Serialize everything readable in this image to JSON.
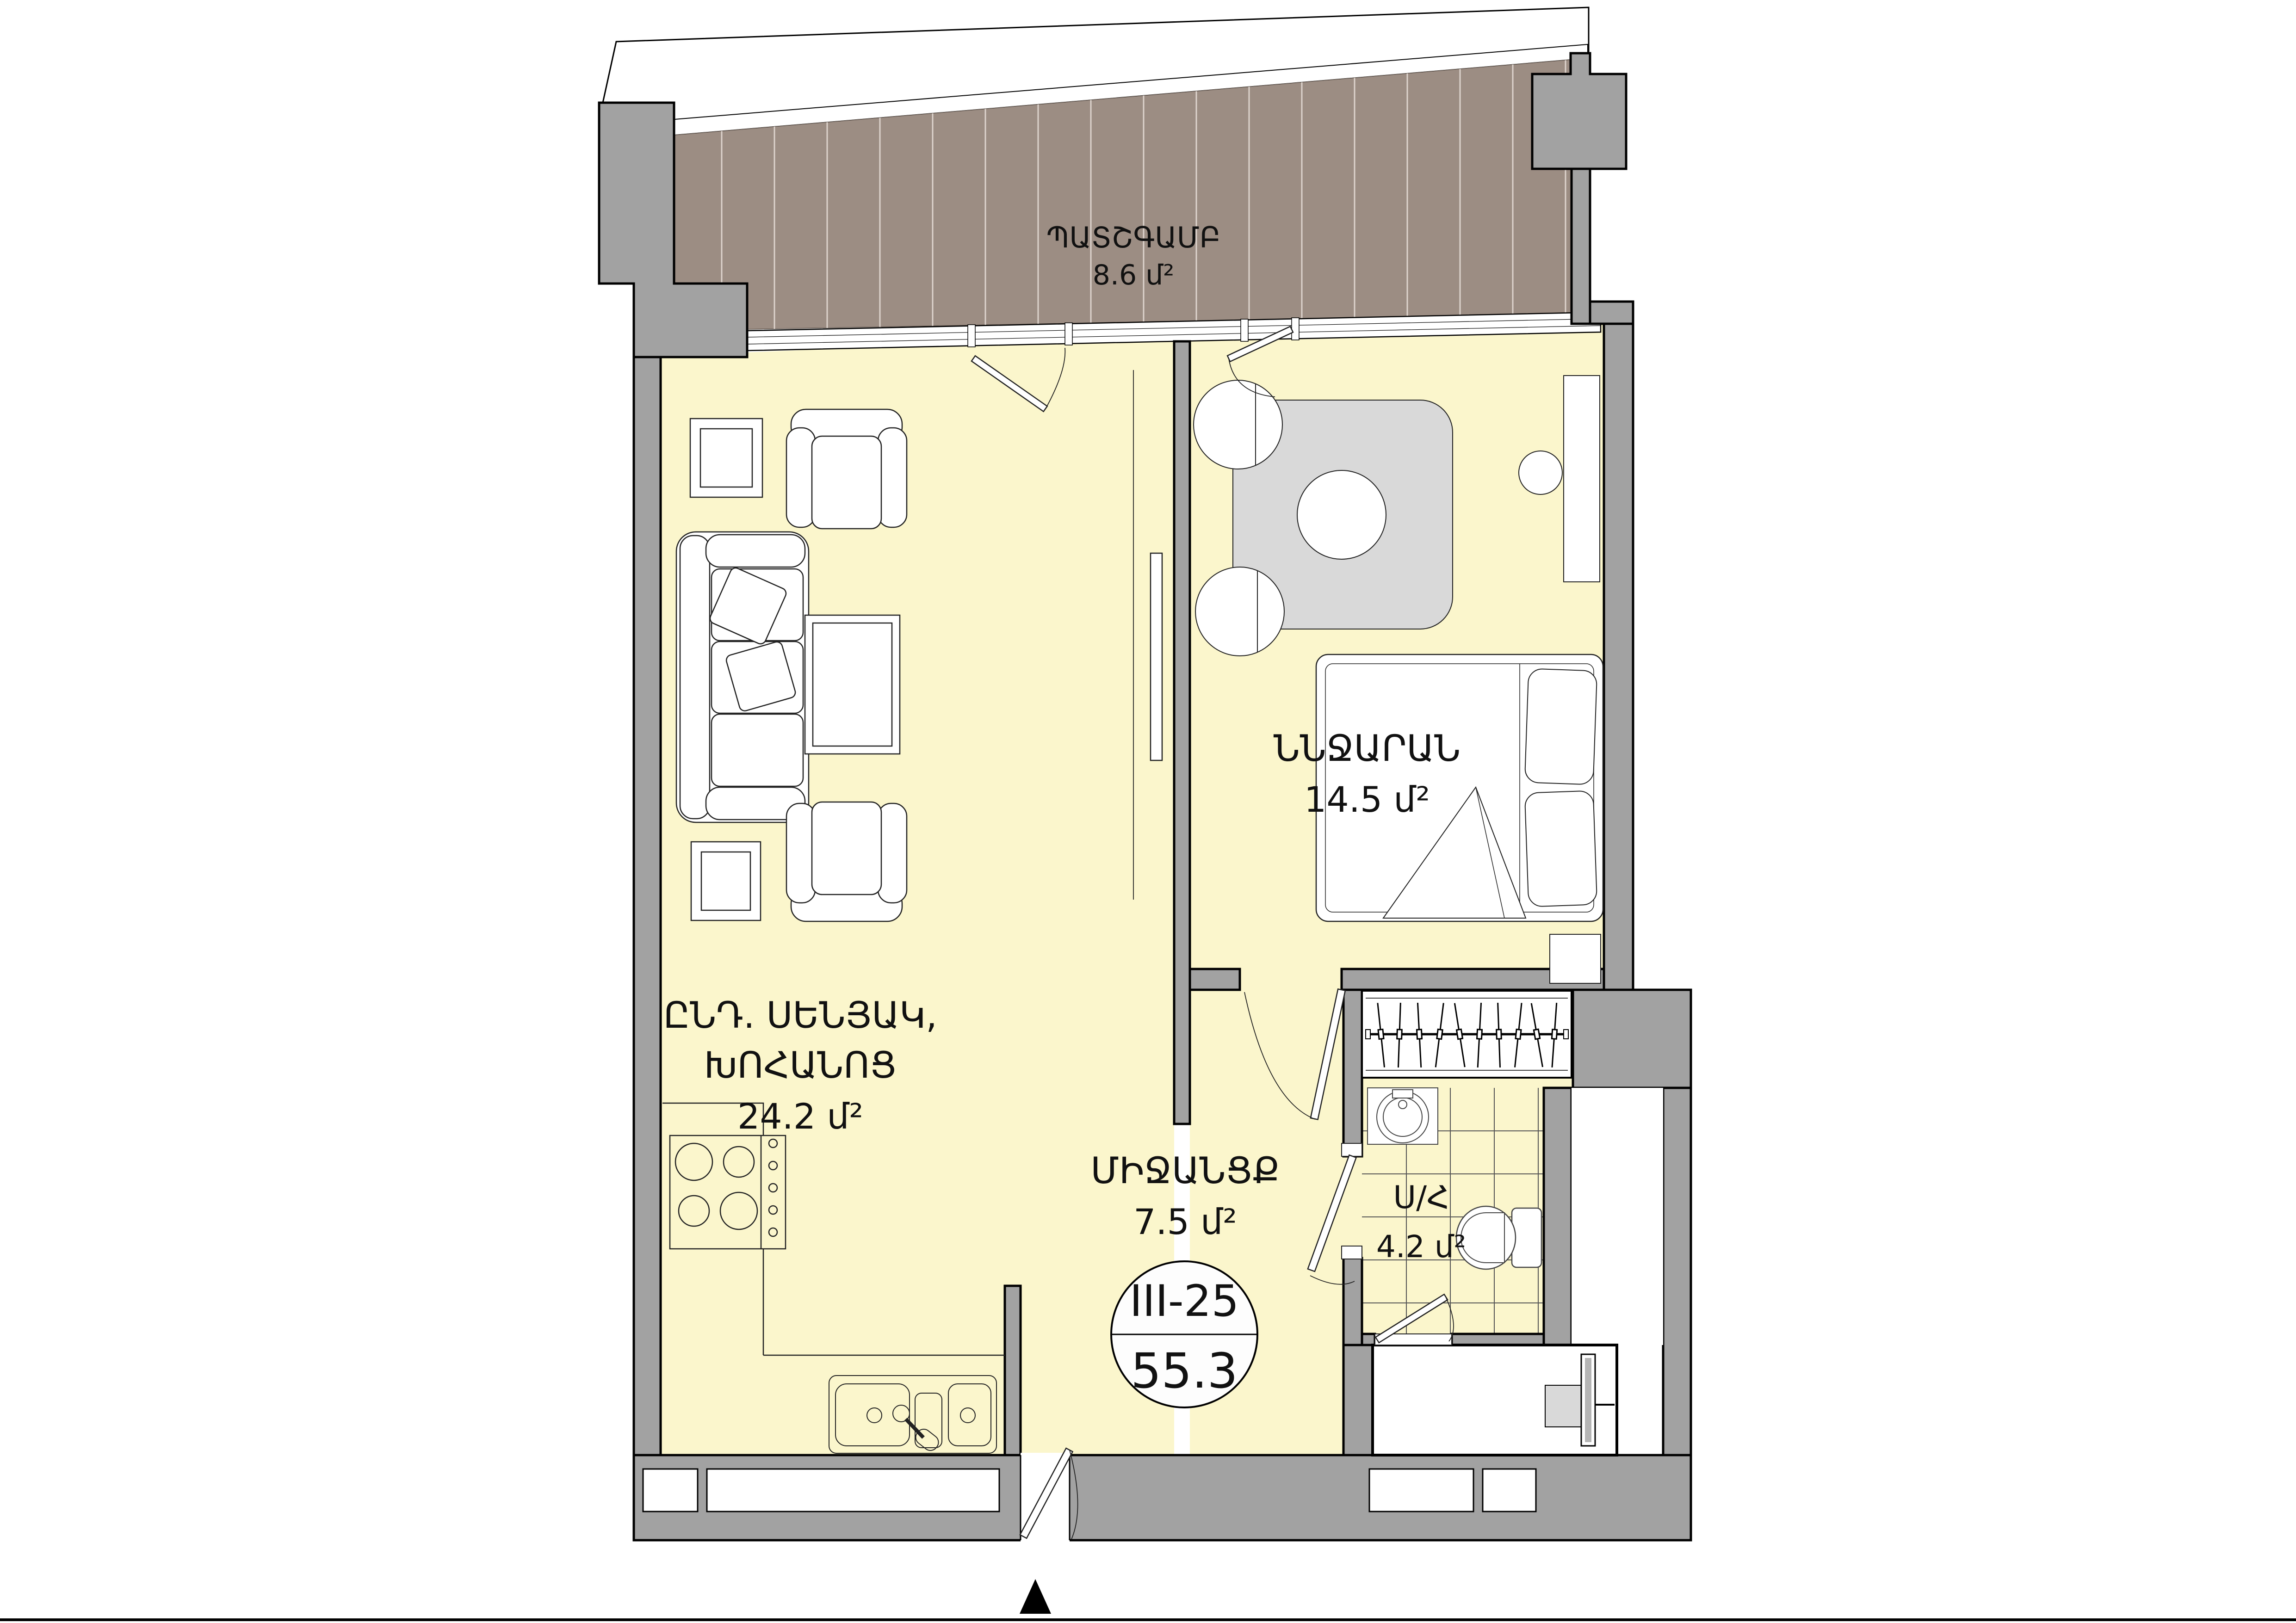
{
  "plan": {
    "labels": {
      "balcony": {
        "name": "ՊԱՏՇԳԱՄԲ",
        "area": "8.6 մ²"
      },
      "living": {
        "line1": "ԸՆԴ. ՍԵՆՅԱԿ,",
        "line2": "ԽՈՀԱՆՈՑ",
        "area": "24.2 մ²"
      },
      "bedroom": {
        "name": "ՆՆՋԱՐԱՆ",
        "area": "14.5 մ²"
      },
      "corridor": {
        "name": "ՄԻՋԱՆՑՔ",
        "area": "7.5 մ²"
      },
      "bathroom": {
        "name": "Ս/Հ",
        "area": "4.2 մ²"
      }
    },
    "unit_badge": {
      "number": "III-25",
      "total_area": "55.3"
    },
    "colors": {
      "wall": "#a2a2a2",
      "floor": "#FBF6CC",
      "balcony_deck": "#9C8D83",
      "rug": "#D9D9D9",
      "outline": "#000000"
    }
  }
}
